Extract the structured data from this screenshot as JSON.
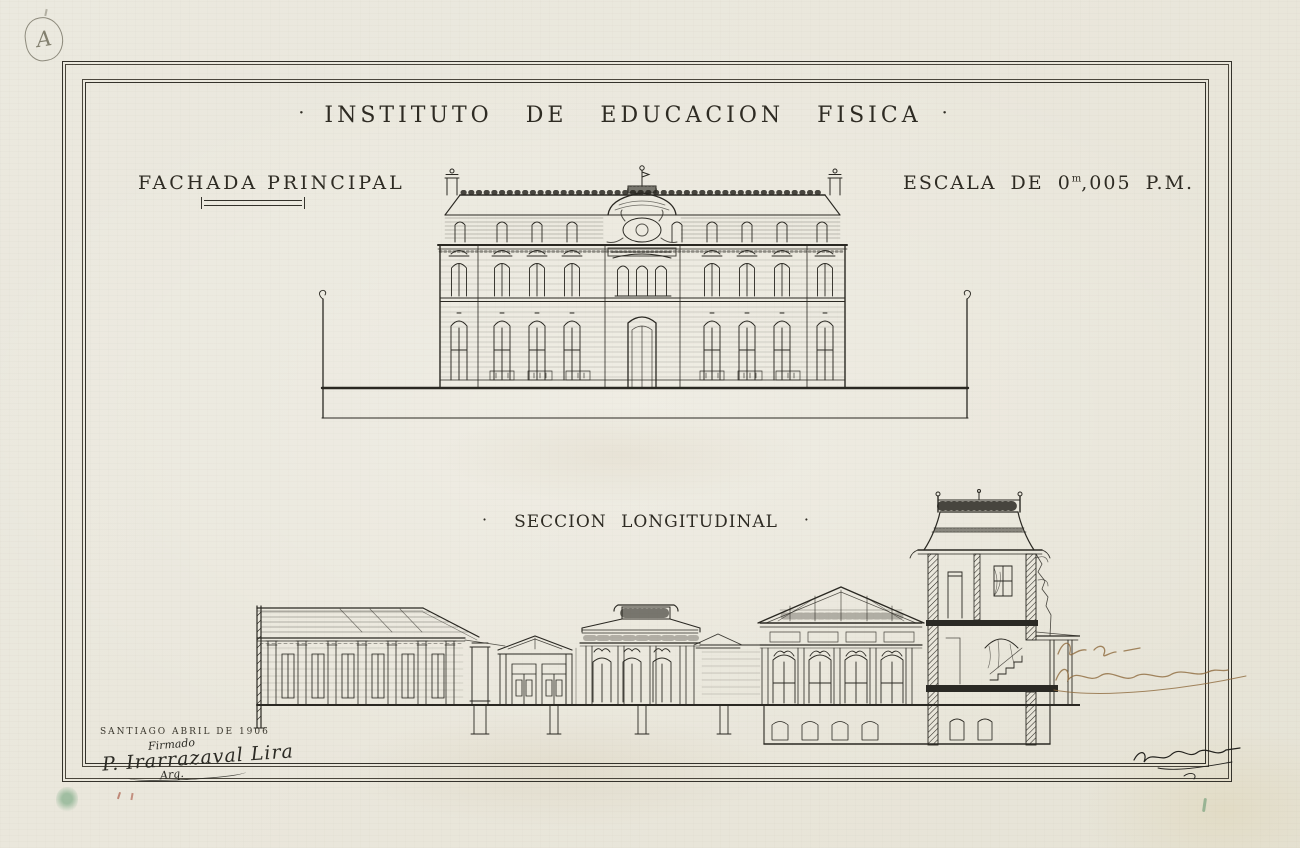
{
  "paper": {
    "background_color": "#eae7dc",
    "ink_color": "#2b2923"
  },
  "corner_mark": {
    "letter": "A"
  },
  "header": {
    "left_dot": "·",
    "title": "INSTITUTO DE EDUCACION FISICA",
    "right_dot": "·"
  },
  "facade": {
    "label": "FACHADA PRINCIPAL"
  },
  "scale_note": {
    "prefix": "ESCALA DE",
    "whole": "0",
    "sup": "m",
    "decimals": ",005",
    "unit": "P.M."
  },
  "section": {
    "left_dot": "·",
    "label": "SECCION LONGITUDINAL",
    "right_dot": "·"
  },
  "title_block": {
    "city_date": "SANTIAGO ABRIL DE 1906",
    "signed_word": "Firmado",
    "signature_name": "P. Irarrazaval Lira",
    "signature_title": "Arq."
  },
  "annotations": {
    "sepia_ink_color": "#8f6b3e",
    "green_mark_color": "#589668"
  }
}
